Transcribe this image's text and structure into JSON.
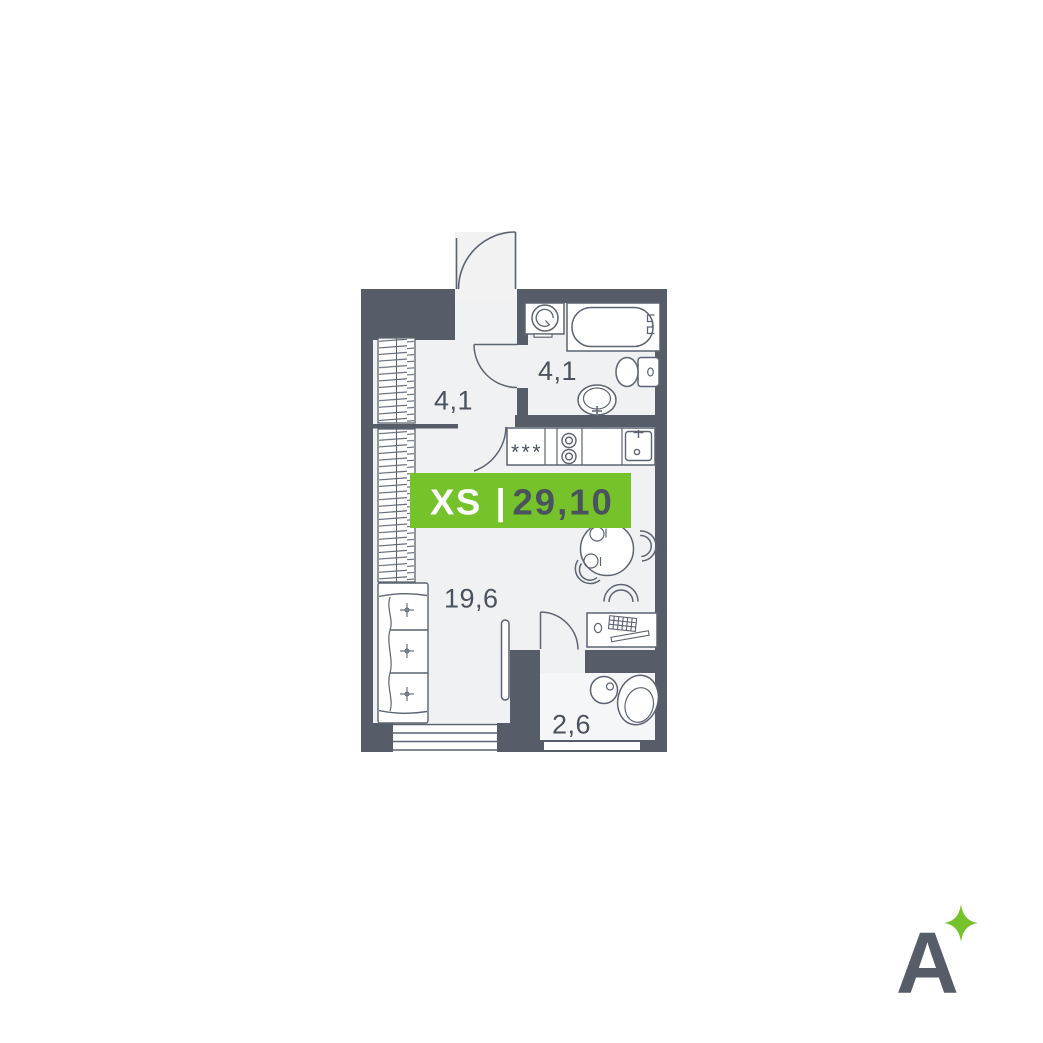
{
  "plan": {
    "badge": {
      "size_label": "XS",
      "separator": "|",
      "area_total": "29,10"
    },
    "rooms": [
      {
        "name": "hallway",
        "area": "4,1"
      },
      {
        "name": "bathroom",
        "area": "4,1"
      },
      {
        "name": "living-kitchen",
        "area": "19,6"
      },
      {
        "name": "balcony",
        "area": "2,6"
      }
    ],
    "refrigerator_marks": "***",
    "fixtures": [
      "entry-door",
      "wardrobe",
      "washing-machine",
      "bathtub",
      "toilet",
      "washbasin",
      "refrigerator",
      "cooktop-2-burner",
      "kitchen-sink",
      "dining-table",
      "dining-chairs",
      "sofa",
      "desk",
      "desk-chair",
      "balcony-armchair",
      "balcony-side-table",
      "window",
      "balcony-door"
    ]
  },
  "logo": {
    "letter": "A",
    "icon": "sparkle-icon"
  },
  "colors": {
    "wall": "#565D68",
    "floor": "#F0F1F2",
    "balcony_floor": "#F5F6F7",
    "line": "#5C6471",
    "label_text": "#4A525E",
    "accent_green": "#76C22B",
    "badge_text_light": "#FFFFFF"
  }
}
